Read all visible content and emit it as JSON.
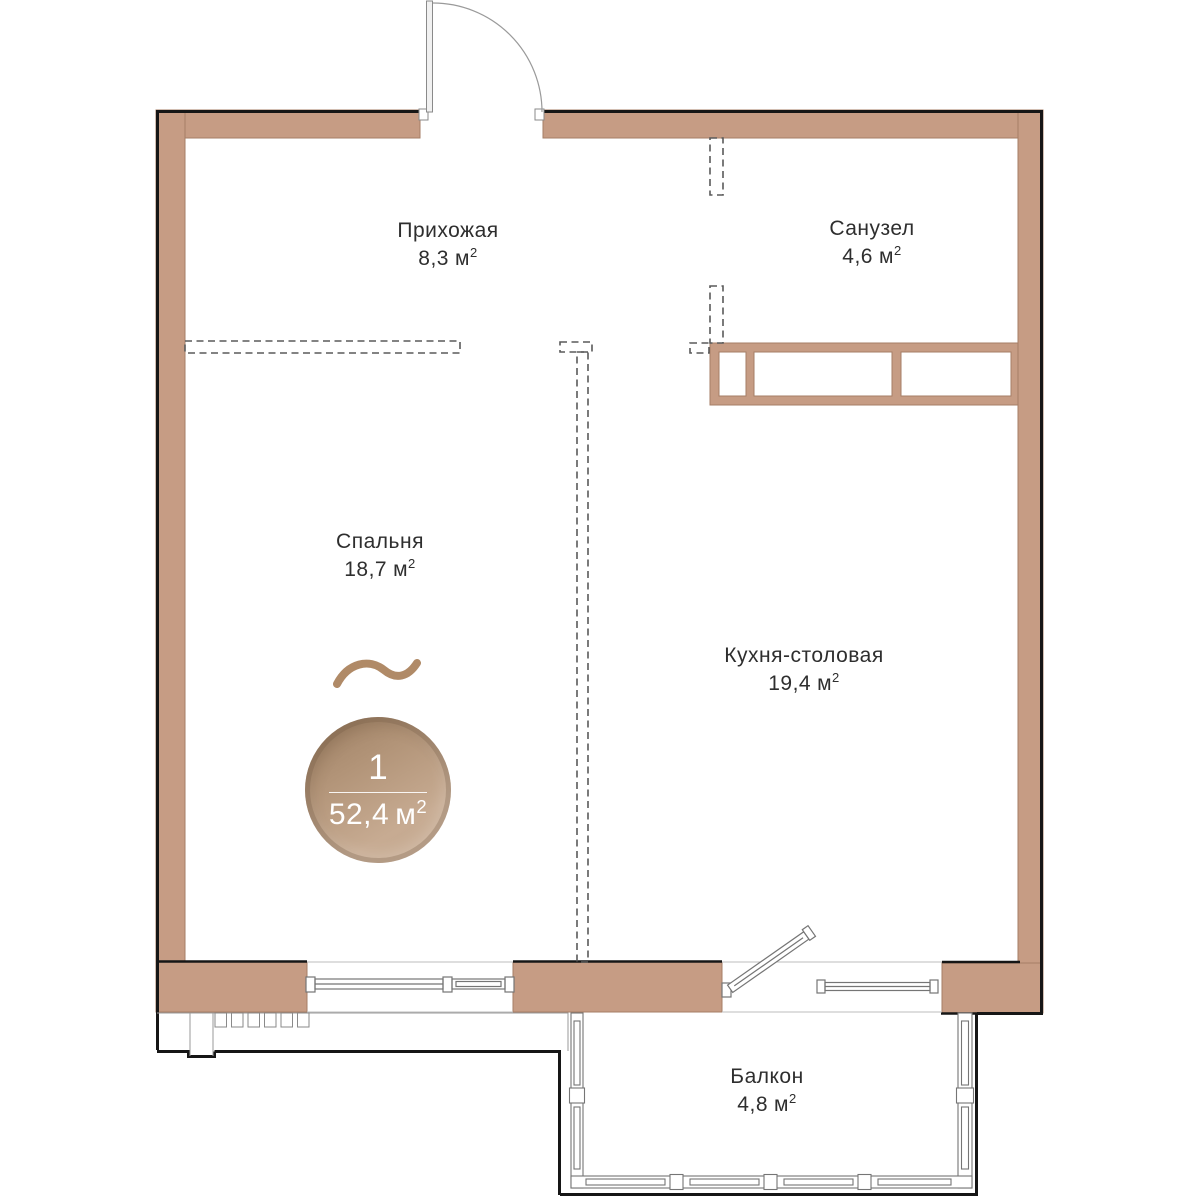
{
  "plan": {
    "kind": "apartment-floor-plan",
    "language": "ru"
  },
  "rooms": [
    {
      "key": "hallway",
      "name": "Прихожая",
      "area": "8,3",
      "unit": "м",
      "sup": "2"
    },
    {
      "key": "bathroom",
      "name": "Санузел",
      "area": "4,6",
      "unit": "м",
      "sup": "2"
    },
    {
      "key": "bedroom",
      "name": "Спальня",
      "area": "18,7",
      "unit": "м",
      "sup": "2"
    },
    {
      "key": "kitchen",
      "name": "Кухня-столовая",
      "area": "19,4",
      "unit": "м",
      "sup": "2"
    },
    {
      "key": "balcony",
      "name": "Балкон",
      "area": "4,8",
      "unit": "м",
      "sup": "2"
    }
  ],
  "badge": {
    "rooms_count": "1",
    "total_area": "52,4",
    "unit": "м",
    "sup": "2"
  },
  "colors": {
    "wall_fill": "#c69c84",
    "wall_edge": "#a57e66",
    "outline": "#161616",
    "dashed_partition": "#5a5a5a",
    "glazing": "#757575",
    "label_text": "#2e2e2e",
    "badge_gradient_start": "#9d7f63",
    "badge_gradient_end": "#c7ab92",
    "wave_accent": "#b08a67"
  }
}
